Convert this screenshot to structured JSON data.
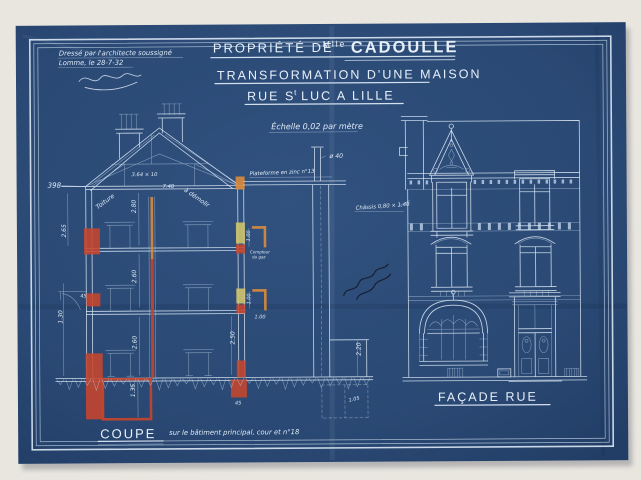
{
  "colors": {
    "paper": "#e9e6e0",
    "sheet_blue": "#2a4974",
    "line_white": "#dce8f4",
    "accent_red": "#c7452e",
    "accent_orange": "#d78a3c",
    "accent_yellow": "#cfc46d",
    "ink_black": "#141824"
  },
  "stamp": {
    "line1": "Dressé par l'architecte soussigné",
    "line2": "Lomme, le 28-7-32"
  },
  "title": {
    "line1_pre": "PROPRIÉTÉ DE",
    "line1_sup": "Mlle",
    "line1_name": "CADOULLE",
    "line2": "TRANSFORMATION D'UNE MAISON",
    "line3_pre": "RUE S",
    "line3_sup": "t",
    "line3_post": "LUC A LILLE",
    "scale": "Échelle 0,02 par mètre"
  },
  "coupe": {
    "label": "COUPE",
    "subtitle": "sur le bâtiment principal, cour et n°18"
  },
  "facade": {
    "label": "FAÇADE RUE"
  },
  "annotations": [
    {
      "text": "398",
      "x": 48,
      "y": 186,
      "r": 0,
      "s": 7
    },
    {
      "text": "3.64 × 10",
      "x": 132,
      "y": 175,
      "r": 0,
      "s": 5.2
    },
    {
      "text": "7.48",
      "x": 163,
      "y": 187,
      "r": 0,
      "s": 5.2
    },
    {
      "text": "à démolir",
      "x": 184,
      "y": 190,
      "r": 35,
      "s": 6.2
    },
    {
      "text": "Toiture",
      "x": 98,
      "y": 208,
      "r": -36,
      "s": 6.2
    },
    {
      "text": "2.80",
      "x": 136,
      "y": 212,
      "r": -90,
      "s": 6
    },
    {
      "text": "2.60",
      "x": 136,
      "y": 282,
      "r": -90,
      "s": 6
    },
    {
      "text": "2.60",
      "x": 136,
      "y": 348,
      "r": -90,
      "s": 6
    },
    {
      "text": "2.50",
      "x": 234,
      "y": 344,
      "r": -90,
      "s": 6
    },
    {
      "text": "2.65",
      "x": 66,
      "y": 236,
      "r": -90,
      "s": 6
    },
    {
      "text": "1.30",
      "x": 62,
      "y": 322,
      "r": -90,
      "s": 6
    },
    {
      "text": "45",
      "x": 80,
      "y": 296,
      "r": 0,
      "s": 5
    },
    {
      "text": "1.00",
      "x": 250,
      "y": 241,
      "r": -90,
      "s": 5
    },
    {
      "text": "Compteur",
      "x": 250,
      "y": 253,
      "r": 0,
      "s": 4
    },
    {
      "text": "du gaz",
      "x": 252,
      "y": 258,
      "r": 0,
      "s": 4
    },
    {
      "text": "1.00",
      "x": 250,
      "y": 304,
      "r": -90,
      "s": 5
    },
    {
      "text": "1.00",
      "x": 254,
      "y": 318,
      "r": 0,
      "s": 5
    },
    {
      "text": "45",
      "x": 234,
      "y": 404,
      "r": 0,
      "s": 5
    },
    {
      "text": "1.35",
      "x": 134,
      "y": 396,
      "r": -90,
      "s": 6
    },
    {
      "text": "2.20",
      "x": 360,
      "y": 356,
      "r": -90,
      "s": 6
    },
    {
      "text": "1.05",
      "x": 348,
      "y": 402,
      "r": -12,
      "s": 5
    },
    {
      "text": "ø 40",
      "x": 330,
      "y": 158,
      "r": 0,
      "s": 6.2
    },
    {
      "text": "Plateforme en zinc n°13",
      "x": 250,
      "y": 175,
      "r": -2,
      "s": 5.4
    },
    {
      "text": "Châssis 0,80 × 1,40",
      "x": 356,
      "y": 210,
      "r": -4,
      "s": 5.4
    }
  ]
}
